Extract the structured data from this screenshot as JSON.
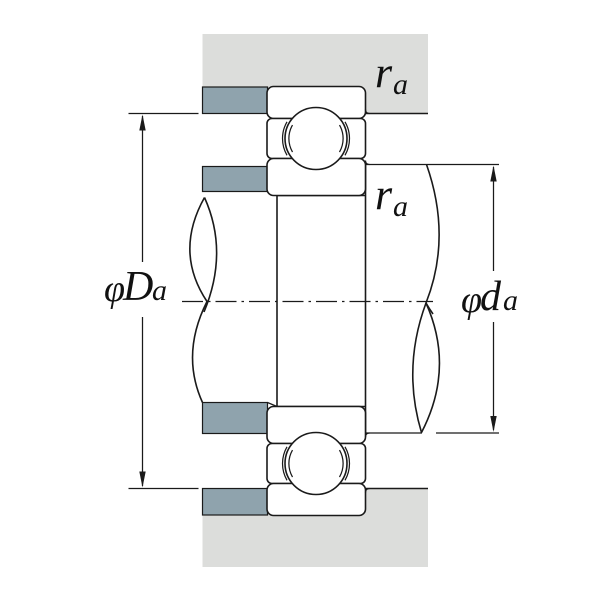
{
  "diagram": {
    "kind": "bearing mounting cross-section with shoulder dimensions",
    "labels": {
      "housing_shoulder_diameter": {
        "phi": "φ",
        "main": "D",
        "sub": "a"
      },
      "shaft_shoulder_diameter": {
        "phi": "φ",
        "main": "d",
        "sub": "a"
      },
      "housing_fillet_radius": {
        "main": "r",
        "sub": "a"
      },
      "shaft_fillet_radius": {
        "main": "r",
        "sub": "a"
      }
    },
    "colors": {
      "housing_fill": "#dcdddb",
      "shoulder_fill": "#8fa3ad",
      "line": "#1a1a1a",
      "background": "#ffffff"
    }
  }
}
